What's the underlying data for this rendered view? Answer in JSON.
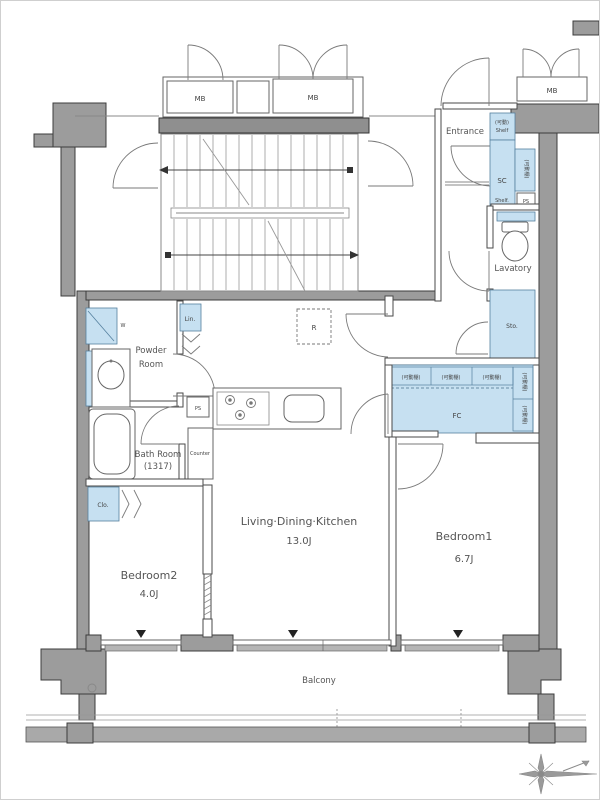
{
  "colors": {
    "wall_gray": "#9c9c9c",
    "wall_dark": "#8f8f8f",
    "fixture_blue": "#c6e0f1",
    "railing_gray": "#a9a9a9",
    "line_dark": "#3c3c3c"
  },
  "labels": {
    "mb_left": "MB",
    "mb_right": "MB",
    "mb_corner": "MB",
    "entrance": "Entrance",
    "shelf_upper_line1": "(可動)",
    "shelf_upper_line2": "Shelf",
    "sc": "SC",
    "sc_side_vertical": "(可動棚)",
    "shelf_lower": "Shelf.",
    "ps_entry": "PS",
    "lavatory": "Lavatory",
    "storage": "Sto.",
    "fc": "FC",
    "fc_shelf1": "(可動棚)",
    "fc_shelf2": "(可動棚)",
    "fc_shelf3": "(可動棚)",
    "fc_side1": "(可動棚)",
    "fc_side2": "(可動棚)",
    "fridge": "R",
    "linen": "Lin.",
    "ps_kitchen": "PS",
    "washer": "W",
    "powder_line1": "Powder",
    "powder_line2": "Room",
    "bath_line1": "Bath Room",
    "bath_line2": "(1317)",
    "counter": "Counter",
    "closet": "Clo.",
    "bedroom2_name": "Bedroom2",
    "bedroom2_size": "4.0J",
    "ldk_name": "Living·Dining·Kitchen",
    "ldk_size": "13.0J",
    "bedroom1_name": "Bedroom1",
    "bedroom1_size": "6.7J",
    "balcony": "Balcony"
  }
}
